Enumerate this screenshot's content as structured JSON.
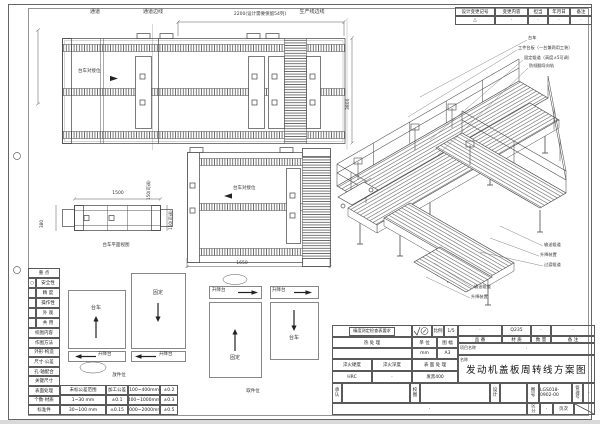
{
  "revision_table": {
    "headers": [
      "设计变更记号",
      "变更内容",
      "担当",
      "年月日",
      "备注"
    ],
    "row": [
      "△",
      "·",
      "·",
      "·",
      "·"
    ]
  },
  "plan": {
    "passage": "通道",
    "passage_edge": "通道边线",
    "dim_2200": "2200(设计需要保留54列)",
    "line_edge": "生产线边线",
    "dock_label_1": "台车对接位",
    "dock_label_2": "台车对接位",
    "dim_150": "150(可调)",
    "dim_3800": "3800",
    "dim_1650": "1650"
  },
  "trolley": {
    "dim_1500": "1500",
    "dim_380": "380",
    "dim_150": "150(可调)",
    "caption": "台车平面视图"
  },
  "iso_callouts": {
    "top": [
      "台车",
      "工件台板（一台兼两用工装）",
      "固定辊道（高度±5可调）",
      "防倾翻导向轨"
    ],
    "mid": [
      "输送辊道",
      "升降装置",
      "过渡辊道"
    ],
    "low": [
      "输送辊道",
      "升降装置"
    ]
  },
  "flow": {
    "left": {
      "box1": "台车",
      "box2": "固定",
      "lift1": "升降台",
      "lift2": "升降台",
      "caption": "放件位"
    },
    "right": {
      "lift1": "升降台",
      "lift2": "升降台",
      "box1": "固定",
      "box2": "台车",
      "caption": "取件位"
    }
  },
  "check_table": {
    "title": "重 点",
    "mark": "○",
    "rows1": [
      "安全性",
      "精 度",
      "操作性",
      "外 观",
      "共 用"
    ],
    "section": "校图内容",
    "rows2": [
      "作图方法",
      "外形·构造",
      "尺寸·公差",
      "孔·轴配合",
      "关键尺寸",
      "表面处理",
      "个数·材质",
      "标准件"
    ]
  },
  "tolerance_table": {
    "rows": [
      [
        "未标公差范围",
        "加工公差",
        "100~400mm",
        "±0.2"
      ],
      [
        "1~30 mm",
        "±0.1",
        "400~1000mm",
        "±0.3"
      ],
      [
        "30~100 mm",
        "±0.15",
        "1000~2000mm",
        "±0.5"
      ]
    ]
  },
  "title_block": {
    "note": "精度测定检查表要求",
    "scale_label": "比例",
    "scale_value": "1/5",
    "heat_label": "热 处 理",
    "unit_label": "单 位",
    "unit_value": "mm",
    "sheet_label": "图 幅",
    "sheet_value": "A3",
    "hard_label": "淬火硬度",
    "hard_value": "HRC",
    "depth_label": "淬火深度",
    "depth_value": "·",
    "surface_label": "表 面 处 理",
    "surface_value": "发黑400",
    "part_label": "品 番",
    "part_value": "·",
    "mat_label": "材 质",
    "mat_value": "Q235",
    "qty_label": "数 量",
    "qty_value": "·",
    "rem_label": "备 注",
    "rem_value": "·",
    "project_label": "项目名称",
    "project_value": "·",
    "name_label": "名称",
    "drawing_title": "发动机盖板周转线方案图",
    "approve_label": "承认",
    "check_label": "校图",
    "design_label": "设计",
    "dwg_no_label": "图号",
    "dwg_no": "LGS018-0902-00",
    "manage_label": "管理号",
    "manage_value": "·",
    "class_label": "区分",
    "class_value": "·",
    "page_label": "页次",
    "footer_note": "·"
  }
}
